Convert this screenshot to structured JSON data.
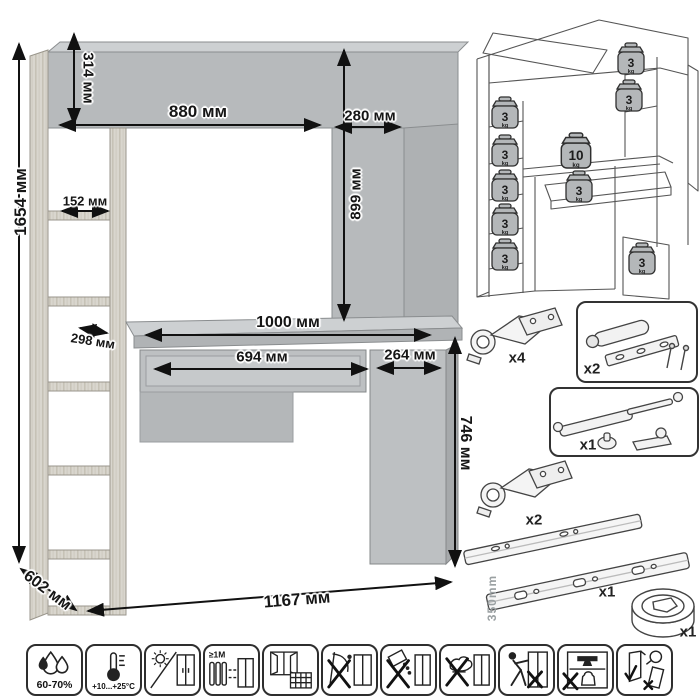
{
  "drawing": {
    "dimensions": {
      "total_height": "1654 мм",
      "hutch_height": "314 мм",
      "hutch_width": "880 мм",
      "side_depth": "280 мм",
      "opening_height": "899 мм",
      "shelf_depth_upper": "152 мм",
      "shelf_depth_lower": "298 мм",
      "desktop_width": "1000 мм",
      "drawer_width": "694 мм",
      "cabinet_width": "264 мм",
      "desk_height": "746 мм",
      "depth": "602 мм",
      "total_width": "1167 мм"
    }
  },
  "schematic": {
    "weights": [
      {
        "location": "left-shelf-1",
        "value": "3",
        "unit": "kg"
      },
      {
        "location": "left-shelf-2",
        "value": "3",
        "unit": "kg"
      },
      {
        "location": "left-shelf-3",
        "value": "3",
        "unit": "kg"
      },
      {
        "location": "left-shelf-4",
        "value": "3",
        "unit": "kg"
      },
      {
        "location": "left-shelf-5",
        "value": "3",
        "unit": "kg"
      },
      {
        "location": "right-shelf-1",
        "value": "3",
        "unit": "kg"
      },
      {
        "location": "right-shelf-2",
        "value": "3",
        "unit": "kg"
      },
      {
        "location": "desktop",
        "value": "10",
        "unit": "kg"
      },
      {
        "location": "drawer",
        "value": "3",
        "unit": "kg"
      },
      {
        "location": "cabinet",
        "value": "3",
        "unit": "kg"
      }
    ]
  },
  "hardware": {
    "items": [
      {
        "name": "door-hinge",
        "qty": "x4"
      },
      {
        "name": "push-latch",
        "qty": "x2"
      },
      {
        "name": "gas-lift",
        "qty": "x1"
      },
      {
        "name": "door-hinge",
        "qty": "x2"
      },
      {
        "name": "drawer-slides",
        "qty": "x1",
        "length": "350mm"
      },
      {
        "name": "cable-grommet",
        "qty": "x1"
      }
    ]
  },
  "care_icons": [
    {
      "name": "humidity",
      "label": "60-70%"
    },
    {
      "name": "temperature-range",
      "label": "+10...+25°C"
    },
    {
      "name": "no-direct-sunlight",
      "label": ""
    },
    {
      "name": "heater-distance",
      "label": "≥1М"
    },
    {
      "name": "ventilation",
      "label": ""
    },
    {
      "name": "no-sharp-tools",
      "label": ""
    },
    {
      "name": "no-spills",
      "label": ""
    },
    {
      "name": "no-wet-cleaning",
      "label": ""
    },
    {
      "name": "no-pushing",
      "label": ""
    },
    {
      "name": "no-heavy-load",
      "label": ""
    },
    {
      "name": "keep-upright",
      "label": ""
    }
  ],
  "colors": {
    "panel_gray": "#b7babc",
    "panel_light": "#c9ccce",
    "panel_dark": "#a6a9ab",
    "wood": "#d9d6ce",
    "line_art": "#555555",
    "dimension_text": "#161616"
  }
}
